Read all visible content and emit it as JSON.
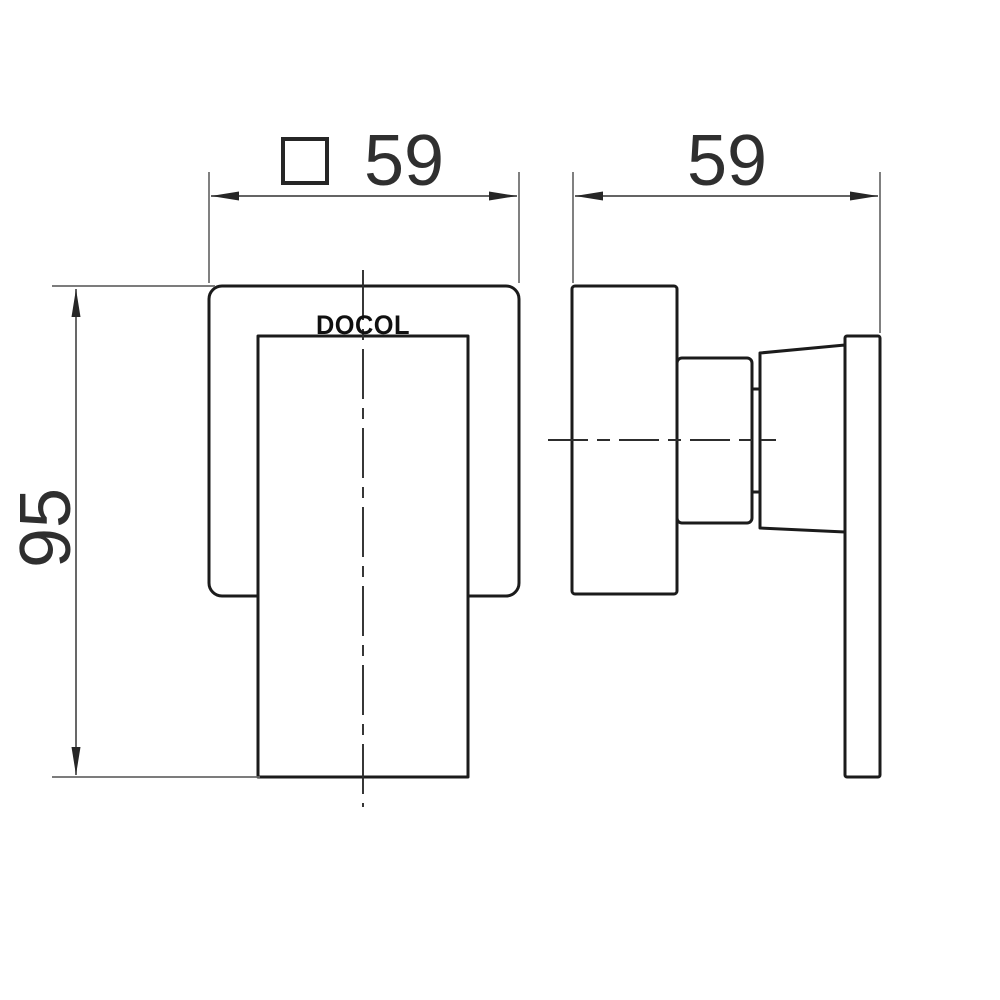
{
  "drawing": {
    "type": "technical-dimension-drawing",
    "brand_label": "DOCOL",
    "dimensions": {
      "front_width": {
        "symbol": "square-profile",
        "value": "59"
      },
      "side_depth": {
        "value": "59"
      },
      "front_height": {
        "value": "95"
      }
    },
    "colors": {
      "object_line": "#1b1b1b",
      "thin_line": "#6a6a6a",
      "dimension_line": "#4e4e4e",
      "centerline": "#2d2d2d",
      "dimension_text": "#2f2f2f",
      "logo_text": "#101010",
      "background": "#ffffff"
    }
  }
}
